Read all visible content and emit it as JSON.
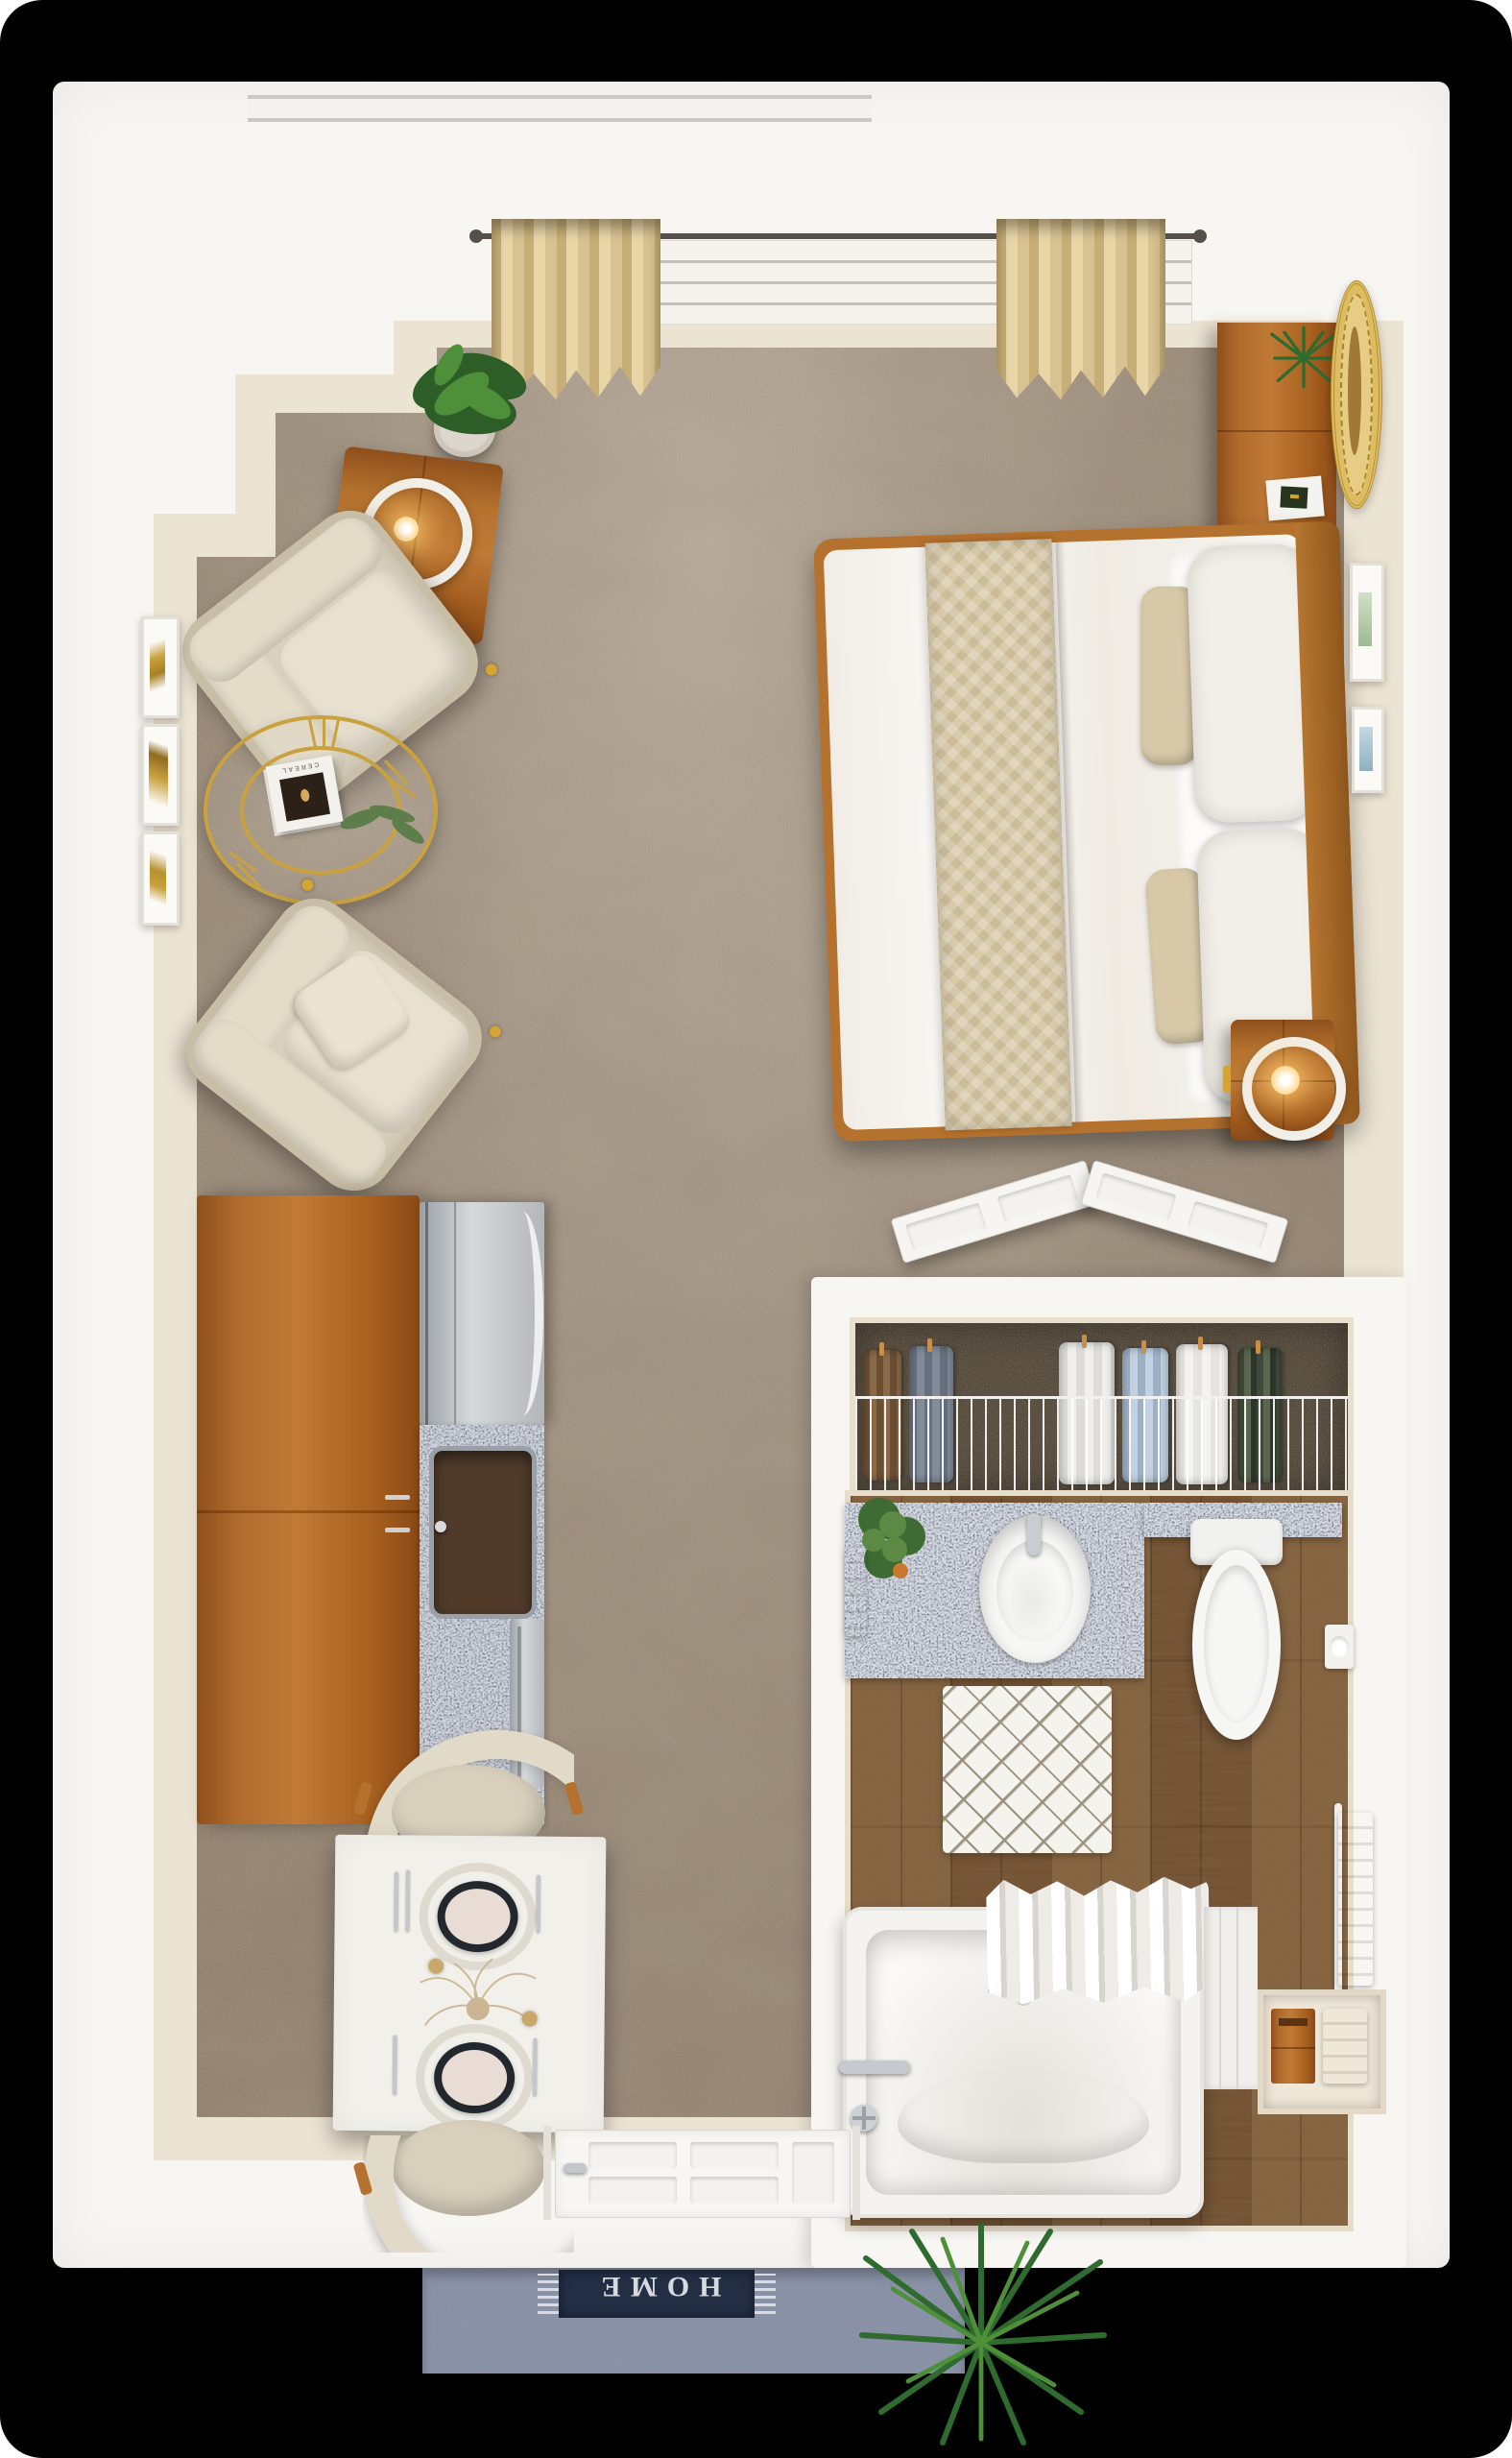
{
  "scene": {
    "title": "Studio apartment floor plan - 3D top-down rendering",
    "view": "top-down",
    "rooms": [
      "living / sleeping area",
      "kitchenette",
      "dining nook",
      "closet",
      "bathroom",
      "entry stoop"
    ]
  },
  "entry": {
    "doormat_text": "HOME"
  },
  "living": {
    "magazine_title": "CEREAL"
  },
  "colors": {
    "background": "#000000",
    "outer_wall": "#f8f6f2",
    "inner_wall_cream": "#ece4d3",
    "carpet": "#877666",
    "bathroom_wood_floor": "#7a5836",
    "cabinet_wood": "#b06b2d",
    "granite_counter": "#667083",
    "gold_accent": "#d4a531",
    "upholstery_beige": "#d9d0bd",
    "curtain_beige": "#d8c291",
    "stoop_concrete": "#8e96ab",
    "doormat_navy": "#232e45",
    "doormat_text_color": "#d5dade",
    "plant_green": "#3a7a35",
    "appliance_steel": "#c6c9cc"
  },
  "furniture": [
    {
      "id": "floor-plant",
      "label": "potted floor plant"
    },
    {
      "id": "side-table",
      "label": "wood side table with ring lamp"
    },
    {
      "id": "armchair-upper",
      "label": "beige armchair"
    },
    {
      "id": "armchair-lower",
      "label": "beige armchair with pillow"
    },
    {
      "id": "coffee-table",
      "label": "round gold glass coffee table"
    },
    {
      "id": "magazine",
      "label": "magazine"
    },
    {
      "id": "wall-art-triptych",
      "label": "gold abstract triptych"
    },
    {
      "id": "curtains",
      "label": "beige window curtains"
    },
    {
      "id": "dresser",
      "label": "wood media dresser"
    },
    {
      "id": "round-wall-decor",
      "label": "round jute wall decor"
    },
    {
      "id": "bed",
      "label": "queen bed with beige runner"
    },
    {
      "id": "nightstand",
      "label": "wood nightstand with ring lamp"
    },
    {
      "id": "framed-art",
      "label": "framed wall art"
    },
    {
      "id": "kitchen-cabinets",
      "label": "kitchenette cabinets"
    },
    {
      "id": "range",
      "label": "stainless range"
    },
    {
      "id": "kitchen-sink",
      "label": "kitchen sink"
    },
    {
      "id": "dishwasher",
      "label": "dishwasher"
    },
    {
      "id": "dining-table",
      "label": "white dining table for two"
    },
    {
      "id": "dining-chairs",
      "label": "upholstered dining chairs"
    },
    {
      "id": "closet",
      "label": "closet with wire shelf and clothes"
    },
    {
      "id": "closet-doors",
      "label": "open double closet doors"
    },
    {
      "id": "vanity",
      "label": "granite vanity with sink"
    },
    {
      "id": "toilet",
      "label": "toilet"
    },
    {
      "id": "bath-mat",
      "label": "diamond pattern bath mat"
    },
    {
      "id": "towel-rack",
      "label": "towel rack"
    },
    {
      "id": "bathtub",
      "label": "bathtub with shower curtain"
    },
    {
      "id": "linen-niche",
      "label": "linen niche with towels"
    },
    {
      "id": "entry-door",
      "label": "white entry door"
    },
    {
      "id": "doormat",
      "label": "HOME doormat"
    },
    {
      "id": "stoop-plant",
      "label": "spiky green plant"
    }
  ]
}
